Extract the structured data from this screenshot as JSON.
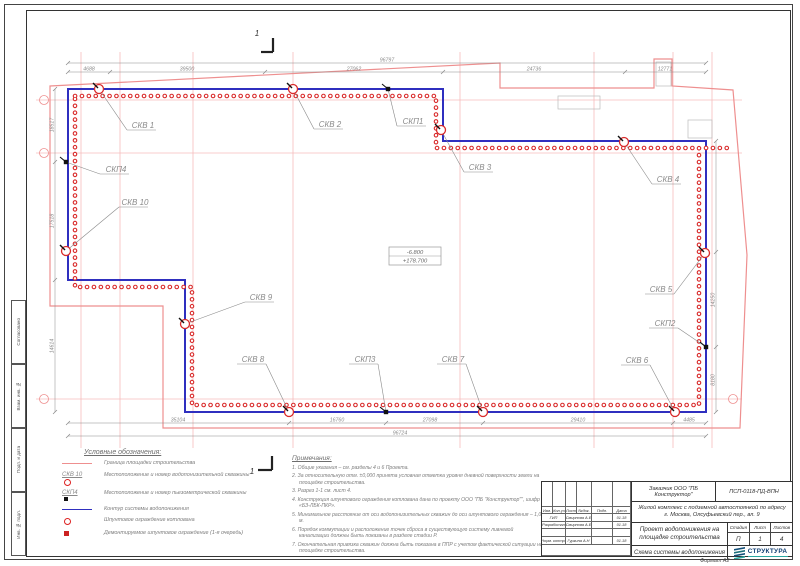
{
  "title_block": {
    "customer": "Заказчик ООО \"ПБ Конструктор\"",
    "doc_code": "ПСП-0118-ПД-ВПН",
    "project": "Жилой комплекс с подземной автостоянкой по адресу г. Москва, Олсуфьевский пер., вл. 9",
    "doc_title": "Проект водопонижения на площадке строительства",
    "sheet_title": "Схема системы водопонижения",
    "stage_label": "Стадия",
    "sheet_label": "Лист",
    "sheets_label": "Листов",
    "stage": "П",
    "sheet": "1",
    "sheets": "4",
    "logo": "СТРУКТУРА",
    "format": "Формат А2",
    "header_cols": [
      "Изм.",
      "Кол.уч",
      "Лист",
      "№док.",
      "Подп.",
      "Дата"
    ],
    "rows": [
      {
        "role": "ГИП",
        "name": "Смирнова А.Е",
        "date": "01.18"
      },
      {
        "role": "Разработал",
        "name": "Смирнова А.Е",
        "date": "01.18"
      },
      {
        "role": "Норм. контр.",
        "name": "Гуркина А.Н",
        "date": "01.18"
      }
    ]
  },
  "side_stamps": [
    "Согласовано",
    "Взам. инв. №",
    "Подп. и дата",
    "Инв. № подл."
  ],
  "legend": {
    "title": "Условные обозначения:",
    "items": [
      {
        "tag": "",
        "text": "Граница площадки строительства"
      },
      {
        "tag": "СКВ 10",
        "text": "Местоположение и номер водопонизительной скважины"
      },
      {
        "tag": "СКП4",
        "text": "Местоположение и номер пьезометрической скважины"
      },
      {
        "tag": "",
        "text": "Контур системы водопонижения"
      },
      {
        "tag": "",
        "text": "Шпунтовое ограждение котлована"
      },
      {
        "tag": "",
        "text": "Демонтируемое шпунтовое ограждение (1-я очередь)"
      }
    ]
  },
  "notes": {
    "title": "Примечания:",
    "items": [
      "1. Общие указания – см. разделы 4 и 6 Проекта.",
      "2. За относительную отм. ±0,000 принята условная отметка уровня дневной поверхности земли на площадке строительства.",
      "3. Разрез 1-1 см. лист 4.",
      "4. Конструкция шпунтового ограждения котлована дана по проекту ООО \"ПБ \"Конструктор\"\", шифр «БЗ-ЛБК-ПКР».",
      "5. Минимальное расстояние от оси водопонизительных скважин до оси шпунтового ограждения – 1,0 м.",
      "6. Порядок коммутации и расположение точек сброса в существующую систему ливневой канализации должны быть показаны в разделе стадии Р.",
      "7. Окончательная привязка скважин должна быть показана в ППР с учетом фактической ситуации на площадке строительства."
    ]
  },
  "plan": {
    "section_mark": "1",
    "elevation": {
      "top": "-6.800",
      "bottom": "+178.700"
    },
    "colors": {
      "contour": "#2f2fbf",
      "sheetpile": "#d92b2b",
      "boundary": "#ee8f8f",
      "grid": "#f6bcbc",
      "dim": "#8a8a8a",
      "label": "#8a8a8a",
      "aux": "#bbbbbb"
    },
    "contour_points": [
      [
        68,
        89
      ],
      [
        443,
        89
      ],
      [
        443,
        141
      ],
      [
        706,
        141
      ],
      [
        706,
        412
      ],
      [
        185,
        412
      ],
      [
        185,
        280
      ],
      [
        68,
        280
      ]
    ],
    "chain_points": [
      [
        75,
        96
      ],
      [
        436,
        96
      ],
      [
        436,
        148
      ],
      [
        699,
        148
      ],
      [
        699,
        405
      ],
      [
        192,
        405
      ],
      [
        192,
        287
      ],
      [
        75,
        287
      ]
    ],
    "chain_ext": [
      [
        706,
        148
      ],
      [
        728,
        148
      ]
    ],
    "boundary_points": [
      [
        50,
        86
      ],
      [
        500,
        63
      ],
      [
        500,
        88
      ],
      [
        654,
        88
      ],
      [
        654,
        59
      ],
      [
        672,
        59
      ],
      [
        672,
        86
      ],
      [
        733,
        90
      ],
      [
        747,
        255
      ],
      [
        740,
        428
      ],
      [
        163,
        428
      ],
      [
        163,
        306
      ],
      [
        50,
        306
      ]
    ],
    "grid_v": [
      81,
      120,
      193,
      293,
      460,
      594,
      673,
      712
    ],
    "grid_h": [
      100,
      153,
      399
    ],
    "grid_bubbles": [
      [
        44,
        100
      ],
      [
        44,
        153
      ],
      [
        44,
        399
      ],
      [
        733,
        399
      ]
    ],
    "aux_rects": [
      [
        558,
        96,
        42,
        13
      ],
      [
        688,
        120,
        24,
        18
      ],
      [
        656,
        62,
        15,
        24
      ]
    ],
    "wells": [
      {
        "id": "СКВ 1",
        "sx": 99,
        "sy": 89,
        "lx": 130,
        "ly": 128
      },
      {
        "id": "СКВ 2",
        "sx": 293,
        "sy": 89,
        "lx": 317,
        "ly": 127
      },
      {
        "id": "СКВ 3",
        "sx": 441,
        "sy": 130,
        "lx": 467,
        "ly": 170
      },
      {
        "id": "СКВ 4",
        "sx": 624,
        "sy": 142,
        "lx": 655,
        "ly": 182
      },
      {
        "id": "СКВ 5",
        "sx": 705,
        "sy": 253,
        "lx": 648,
        "ly": 292
      },
      {
        "id": "СКВ 6",
        "sx": 675,
        "sy": 412,
        "lx": 624,
        "ly": 363
      },
      {
        "id": "СКВ 7",
        "sx": 483,
        "sy": 412,
        "lx": 440,
        "ly": 362
      },
      {
        "id": "СКВ 8",
        "sx": 289,
        "sy": 412,
        "lx": 240,
        "ly": 362
      },
      {
        "id": "СКВ 9",
        "sx": 185,
        "sy": 324,
        "lx": 248,
        "ly": 300
      },
      {
        "id": "СКВ 10",
        "sx": 66,
        "sy": 251,
        "lx": 122,
        "ly": 205
      }
    ],
    "piezometers": [
      {
        "id": "СКП1",
        "sx": 388,
        "sy": 89,
        "lx": 400,
        "ly": 124
      },
      {
        "id": "СКП2",
        "sx": 706,
        "sy": 347,
        "lx": 652,
        "ly": 326
      },
      {
        "id": "СКП3",
        "sx": 386,
        "sy": 412,
        "lx": 352,
        "ly": 362
      },
      {
        "id": "СКП4",
        "sx": 66,
        "sy": 162,
        "lx": 103,
        "ly": 172
      }
    ],
    "dims": {
      "top": {
        "y": 72,
        "x1": 68,
        "x2": 706,
        "ticks": [
          68,
          110,
          265,
          443,
          625,
          706
        ],
        "labels": [
          {
            "x": 89,
            "t": "4688"
          },
          {
            "x": 187,
            "t": "39500"
          },
          {
            "x": 354,
            "t": "27062"
          },
          {
            "x": 534,
            "t": "24736"
          },
          {
            "x": 665,
            "t": "12771"
          }
        ]
      },
      "top_total": {
        "y": 63,
        "x1": 68,
        "x2": 706,
        "ticks": [
          68,
          706
        ],
        "labels": [
          {
            "x": 387,
            "t": "96797"
          }
        ]
      },
      "bottom": {
        "y": 423,
        "x1": 68,
        "x2": 706,
        "ticks": [
          68,
          289,
          386,
          483,
          673,
          706
        ],
        "labels": [
          {
            "x": 178,
            "t": "35104"
          },
          {
            "x": 337,
            "t": "16760"
          },
          {
            "x": 430,
            "t": "27098"
          },
          {
            "x": 578,
            "t": "29410"
          },
          {
            "x": 689,
            "t": "4485"
          }
        ]
      },
      "bottom_total": {
        "y": 436,
        "x1": 68,
        "x2": 706,
        "ticks": [
          68,
          706
        ],
        "labels": [
          {
            "x": 400,
            "t": "96724"
          }
        ]
      },
      "left": {
        "x": 55,
        "y1": 89,
        "y2": 412,
        "ticks": [
          89,
          162,
          280,
          412
        ],
        "labels": [
          {
            "y": 125,
            "t": "18517"
          },
          {
            "y": 221,
            "t": "17518"
          },
          {
            "y": 346,
            "t": "14614"
          }
        ]
      },
      "right": {
        "x": 716,
        "y1": 141,
        "y2": 412,
        "ticks": [
          141,
          252,
          347,
          412
        ],
        "labels": [
          {
            "y": 300,
            "t": "14250"
          },
          {
            "y": 380,
            "t": "8180"
          }
        ]
      }
    },
    "section_marks": {
      "top": {
        "vx": 273,
        "vy1": 38,
        "vy2": 52,
        "hx1": 261,
        "hy": 52,
        "tx": 257,
        "ty": 36
      },
      "bottom": {
        "vx": 272,
        "vy1": 456,
        "vy2": 470,
        "hx1": 258,
        "hy": 470,
        "tx": 252,
        "ty": 474
      }
    },
    "elev_box": {
      "x": 389,
      "y": 247,
      "w": 52,
      "h": 18
    }
  }
}
